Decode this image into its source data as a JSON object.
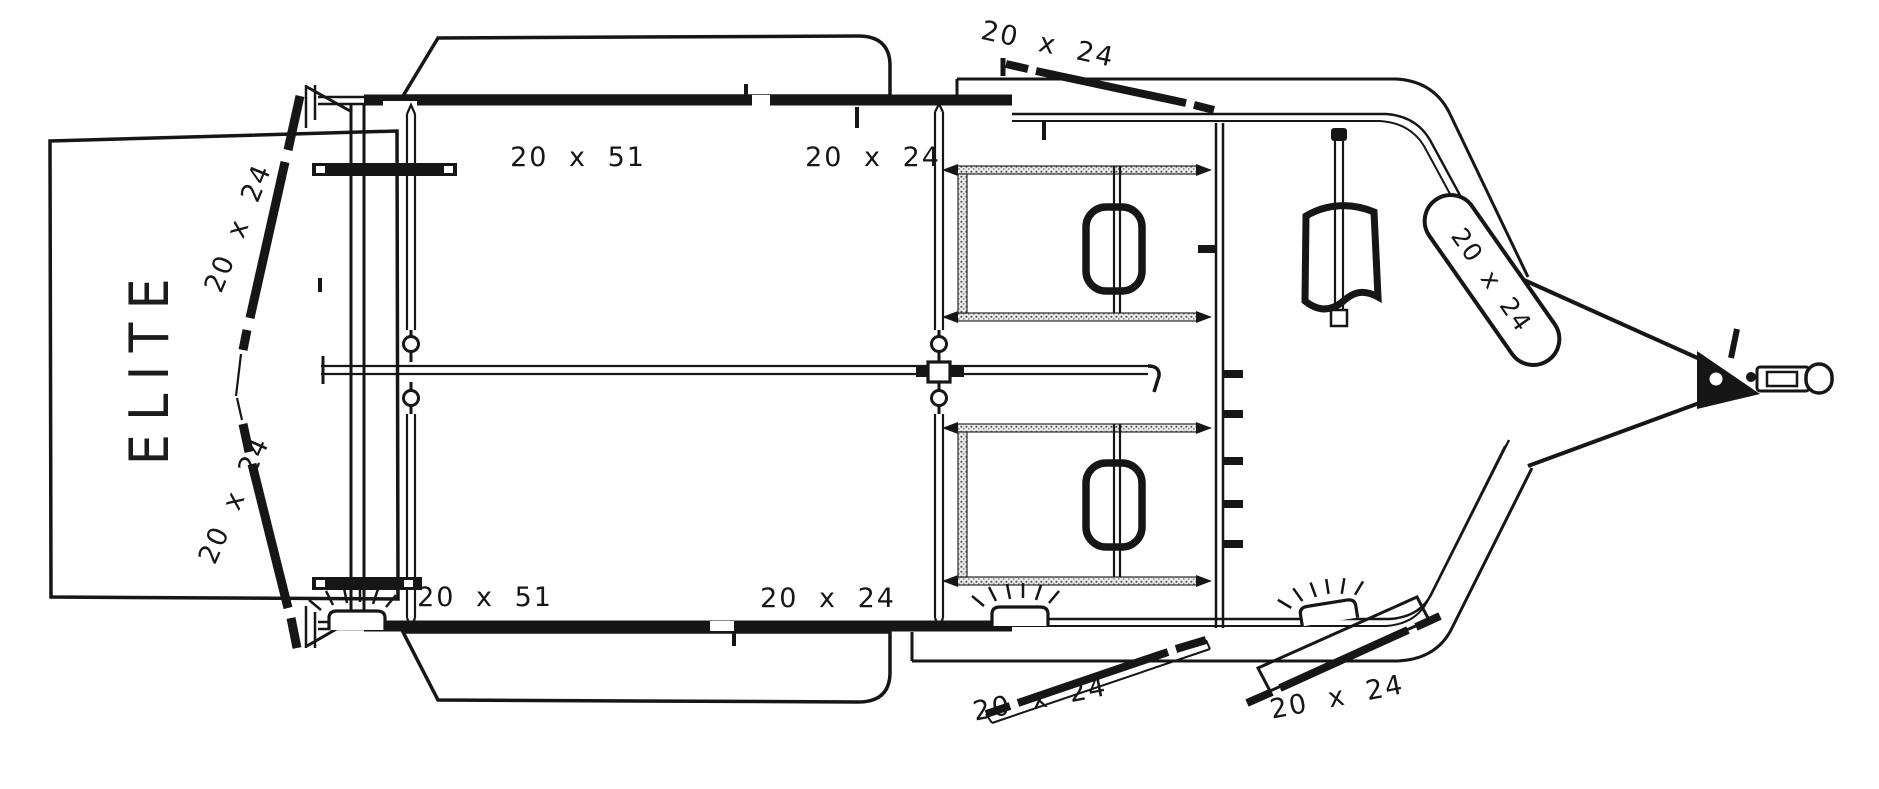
{
  "diagram": {
    "brand": "ELITE",
    "dimension_labels": {
      "rear_door_top": "20 x 24",
      "rear_door_bottom": "20 x 24",
      "rear_window_top": "20 x 51",
      "rear_window_bottom": "20 x 51",
      "mid_window_top": "20 x 24",
      "mid_window_bottom": "20 x 24",
      "side_door_top": "20 x 24",
      "side_door_bottom_left": "20 x 24",
      "side_door_bottom_right": "20 x 24",
      "nose_window": "20 x 24"
    },
    "line_color": "#161616",
    "background_color": "#ffffff"
  }
}
